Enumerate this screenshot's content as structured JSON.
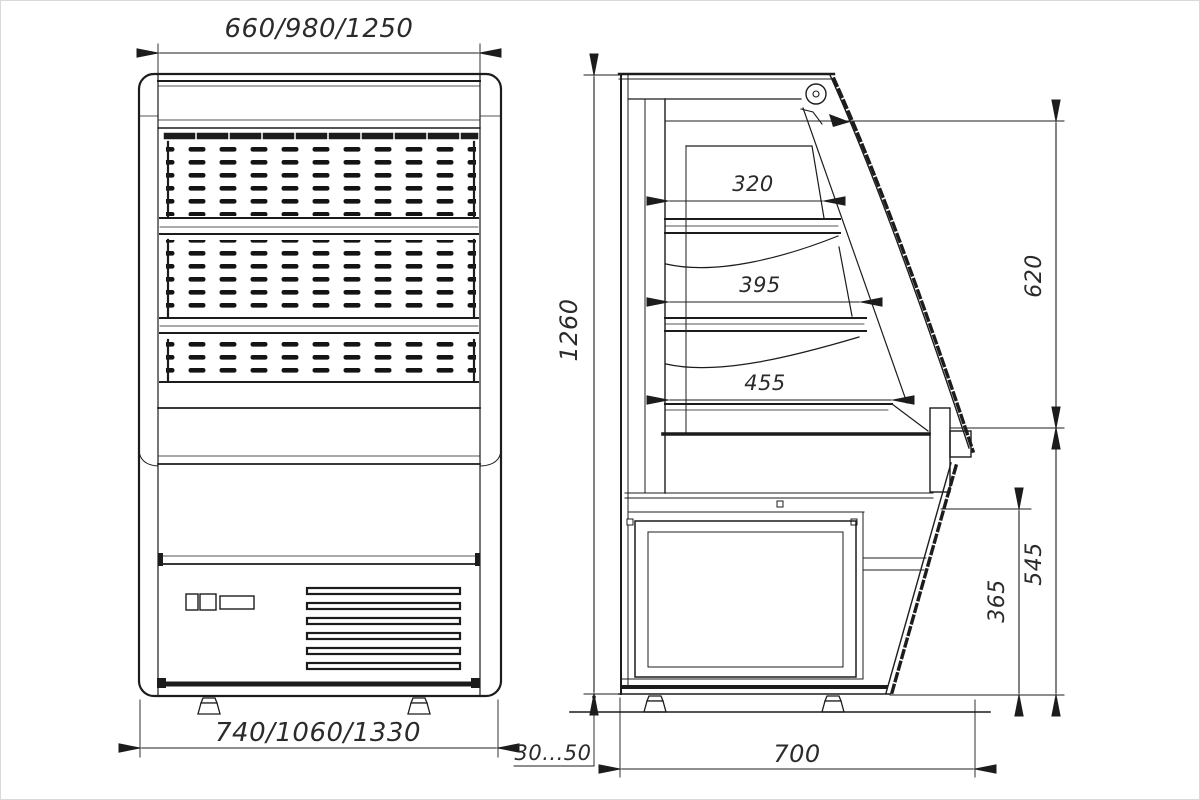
{
  "drawing": {
    "subject": "refrigerated-open-display-case-two-view-technical-drawing",
    "views": [
      "front",
      "side"
    ]
  },
  "colors": {
    "background": "#ffffff",
    "line": "#1c1c1c",
    "text": "#2b2b2b"
  },
  "dimensions": {
    "overall_width_top": "660/980/1250",
    "overall_width_bottom": "740/1060/1330",
    "overall_height": "1260",
    "shelf_top_depth": "320",
    "shelf_middle_depth": "395",
    "shelf_bottom_depth": "455",
    "opening_height": "620",
    "lower_section_height": "545",
    "machine_compartment_height": "365",
    "body_depth": "700",
    "leg_adjustment_range": "30...50"
  }
}
